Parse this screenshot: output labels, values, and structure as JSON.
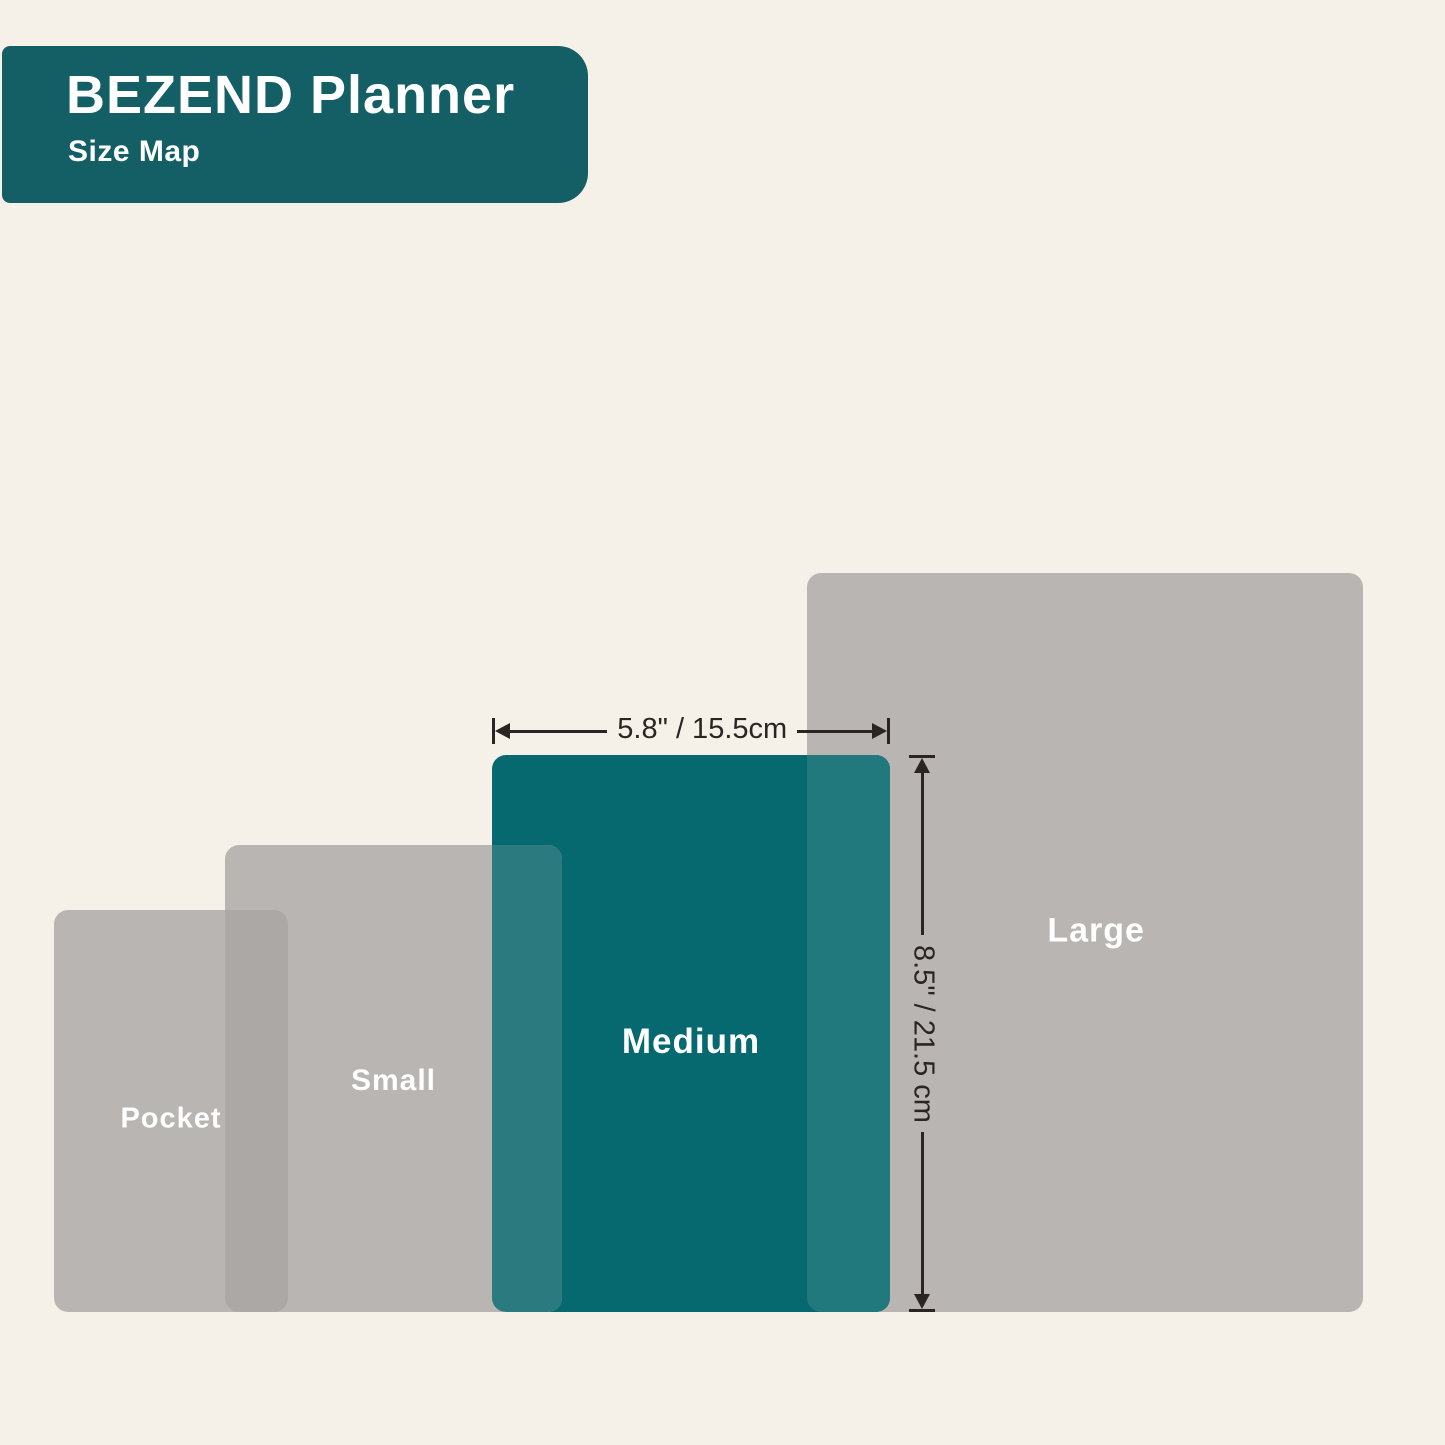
{
  "header": {
    "title": "BEZEND Planner",
    "subtitle": "Size Map"
  },
  "sizes": [
    {
      "id": "pocket",
      "label": "Pocket",
      "highlighted": false
    },
    {
      "id": "small",
      "label": "Small",
      "highlighted": false
    },
    {
      "id": "medium",
      "label": "Medium",
      "highlighted": true,
      "width_annotation": "5.8\" / 15.5cm",
      "height_annotation": "8.5\" / 21.5 cm"
    },
    {
      "id": "large",
      "label": "Large",
      "highlighted": false
    }
  ],
  "dimensions": {
    "width_label": "5.8\" / 15.5cm",
    "height_label": "8.5\" / 21.5 cm"
  },
  "colors": {
    "background": "#F5F1E9",
    "banner_teal": "#135F65",
    "medium_teal": "#05696F",
    "planner_gray": "#B8B5B3",
    "overlap_gray": "#ABA8A6",
    "overlap_teal_small": "#2B7A80",
    "overlap_teal_large": "#21787D",
    "dimension_ink": "#2A2522",
    "label_white": "#FFFFFF"
  }
}
